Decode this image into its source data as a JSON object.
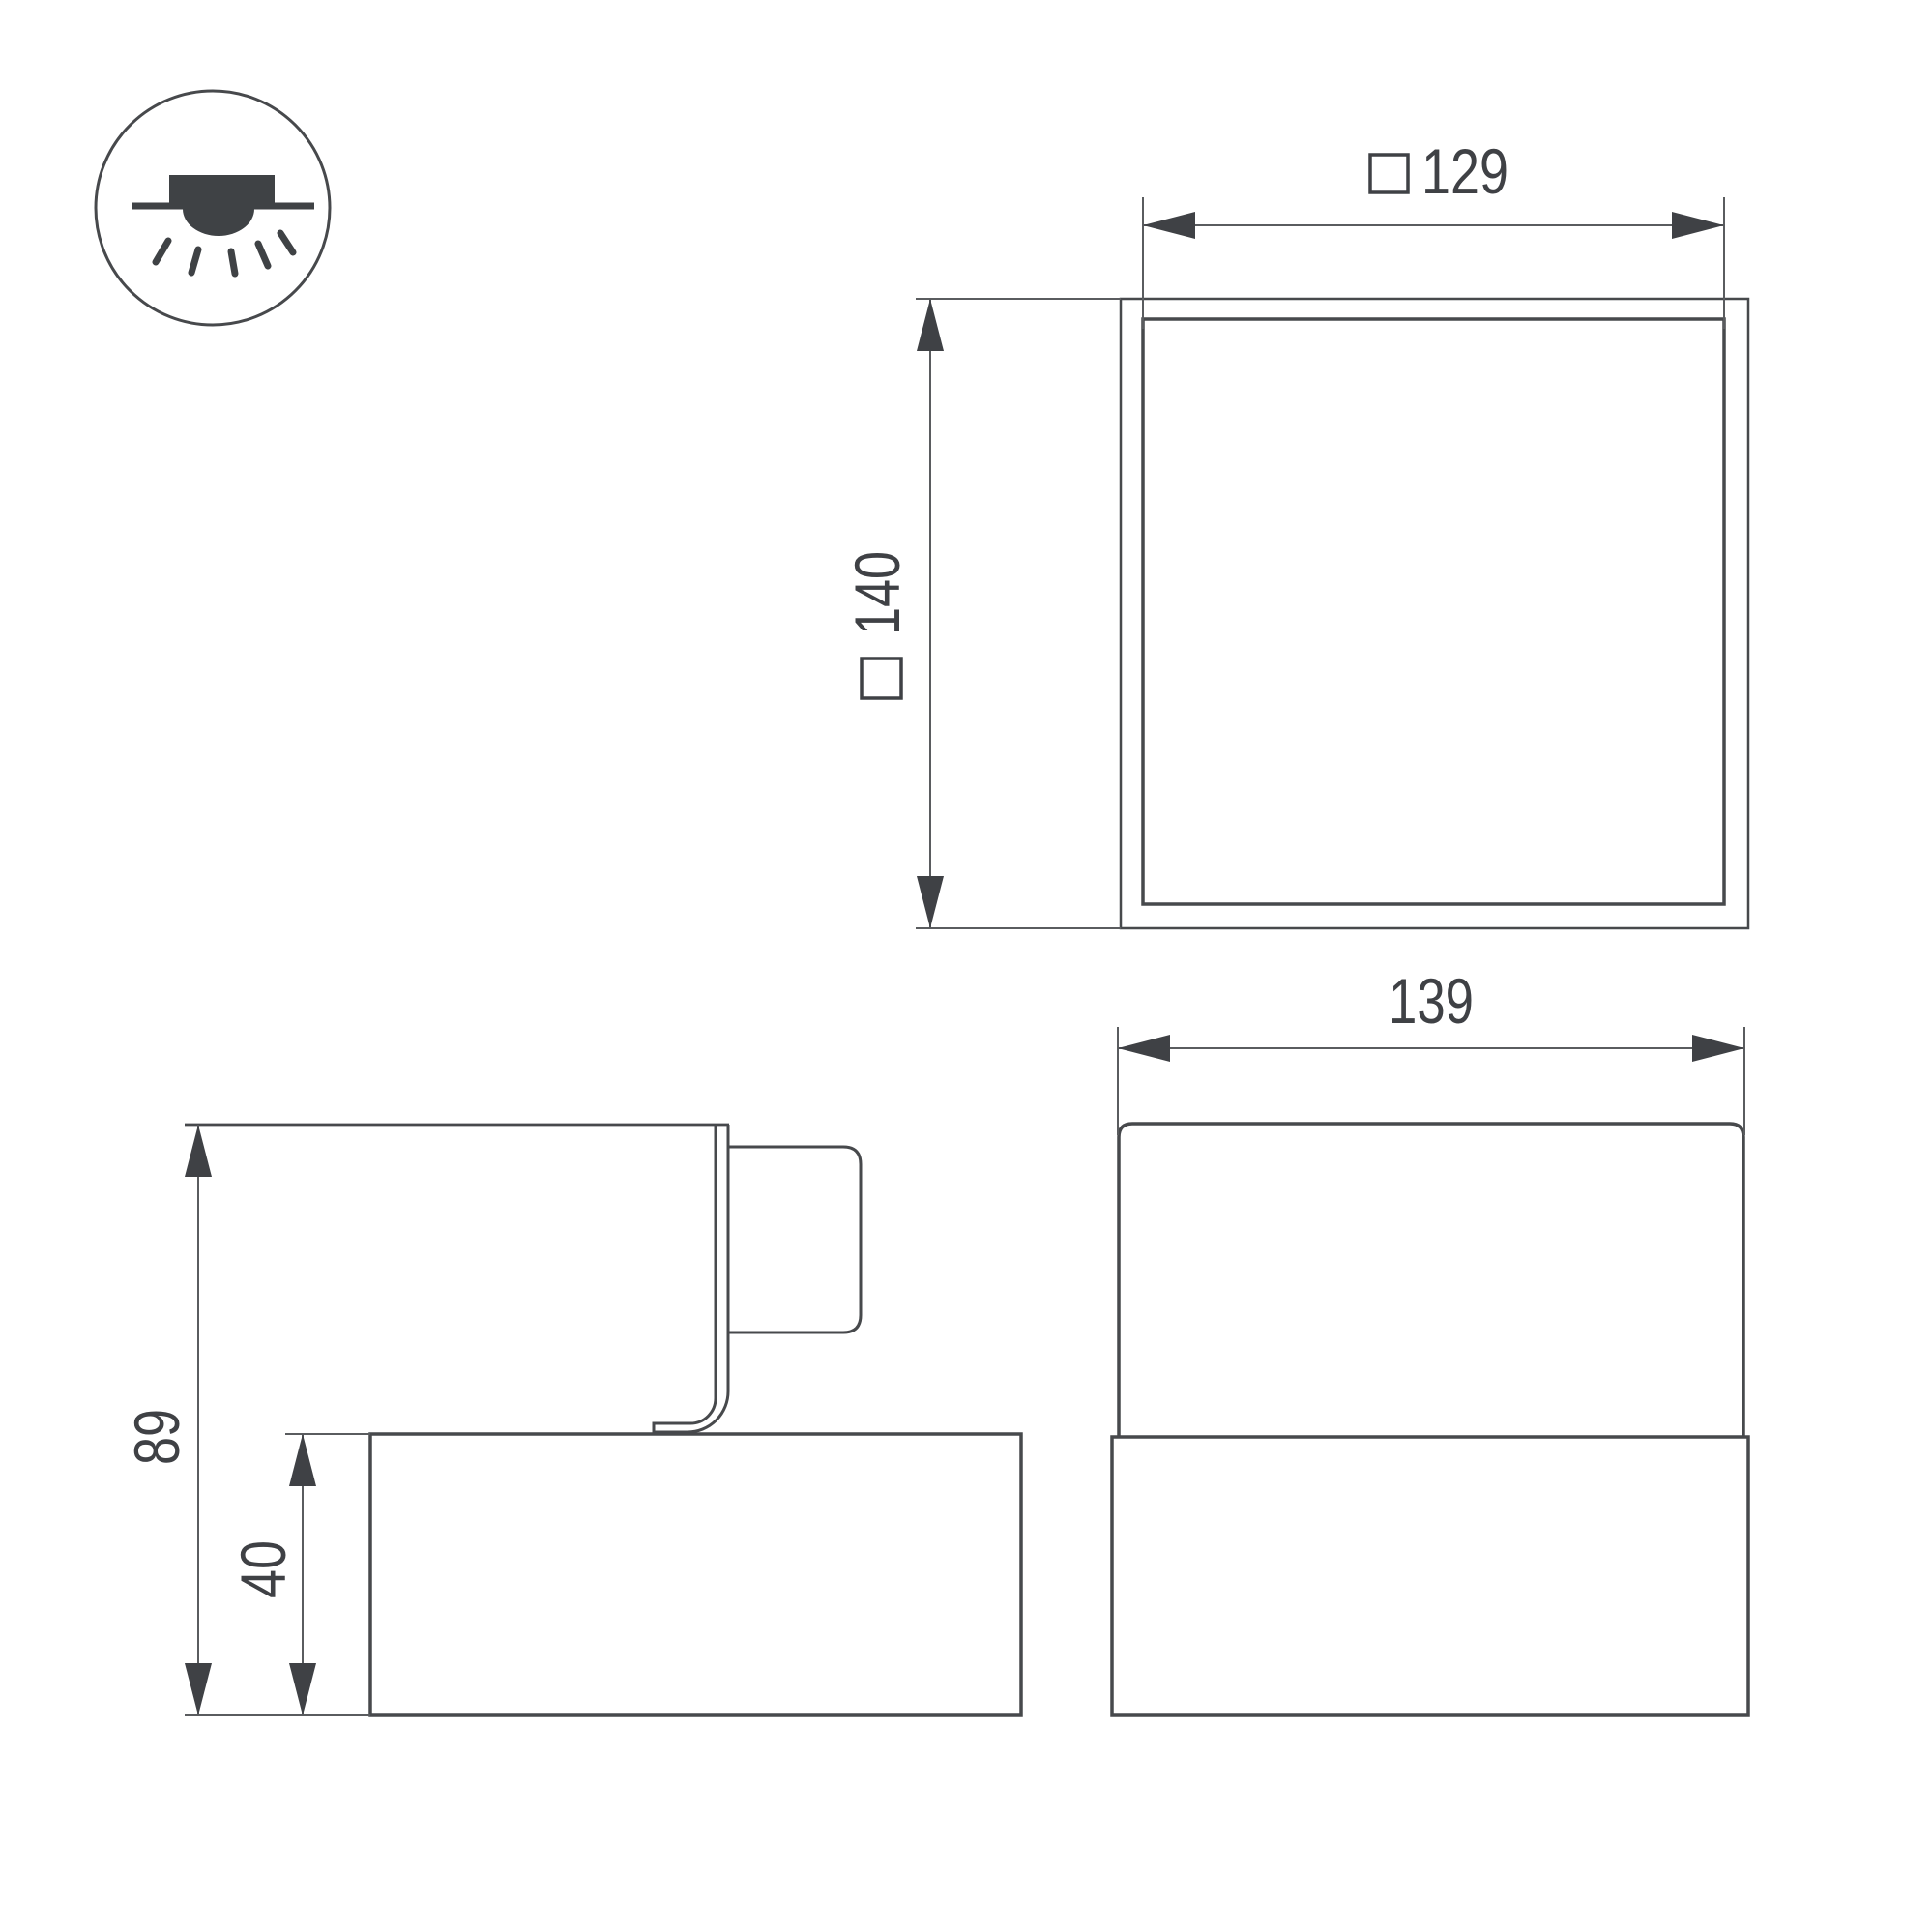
{
  "title": "luminaire-dimension-drawing",
  "colors": {
    "background": "#ffffff",
    "outline": "#47494c",
    "dimension_line": "#5a5c5f",
    "text": "#3f4145",
    "icon_fill": "#3f4245"
  },
  "legend_icon": {
    "name": "recessed-ceiling-light-symbol"
  },
  "views": {
    "plan": {
      "inner_dimension": {
        "symbol": "□",
        "value": "129"
      },
      "outer_dimension": {
        "symbol": "□",
        "value": "140"
      }
    },
    "front": {
      "width_dimension": {
        "value": "139"
      }
    },
    "side": {
      "overall_height_dimension": {
        "value": "89"
      },
      "base_height_dimension": {
        "value": "40"
      }
    }
  }
}
